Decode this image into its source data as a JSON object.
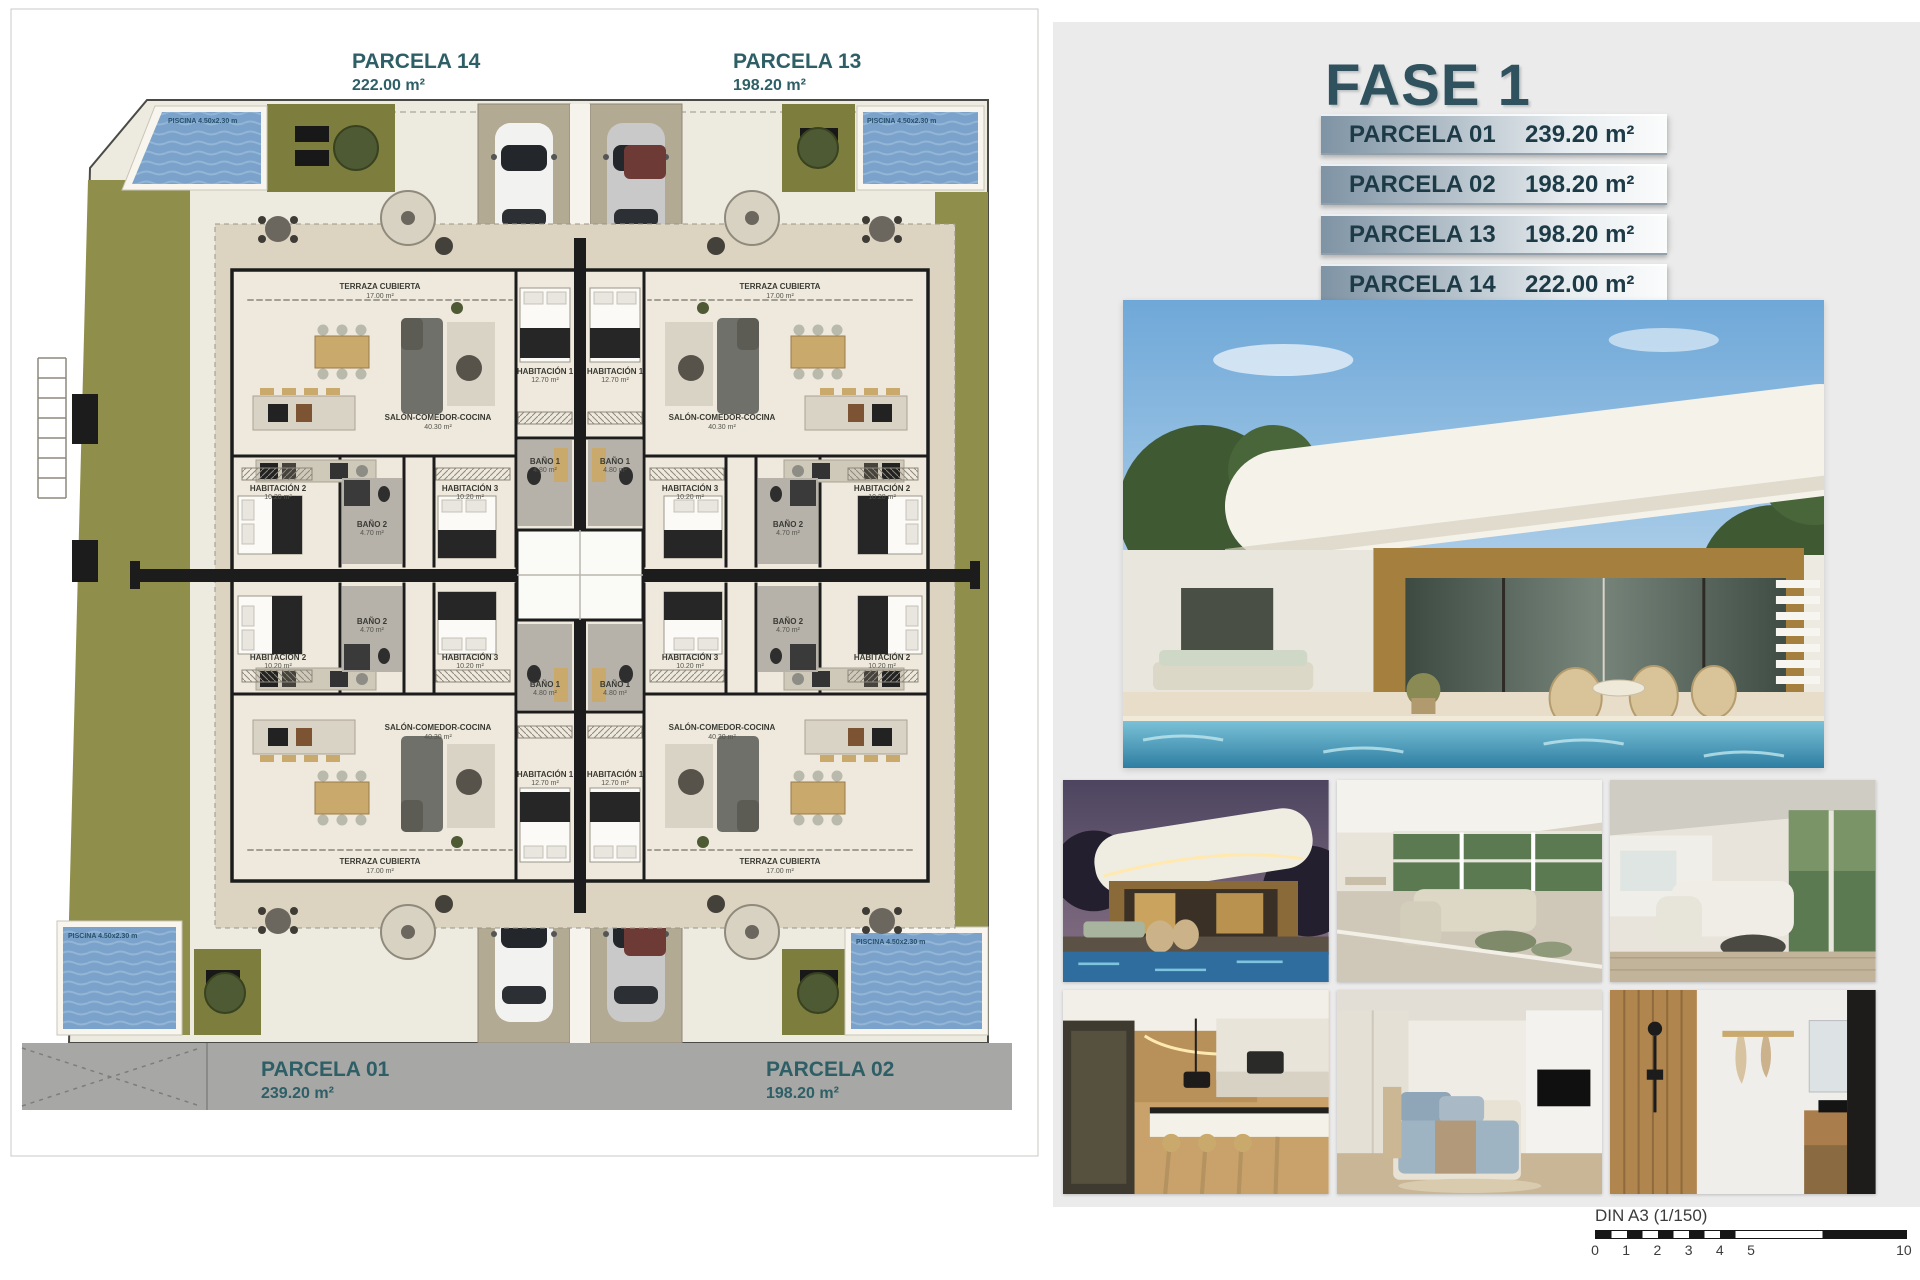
{
  "plan": {
    "parcels": {
      "top_left": {
        "name": "PARCELA 14",
        "area": "222.00 m²"
      },
      "top_right": {
        "name": "PARCELA 13",
        "area": "198.20 m²"
      },
      "bottom_left": {
        "name": "PARCELA 01",
        "area": "239.20 m²"
      },
      "bottom_right": {
        "name": "PARCELA 02",
        "area": "198.20 m²"
      }
    },
    "pool_label": "PISCINA 4.50x2.30 m",
    "rooms": {
      "terraza": {
        "label": "TERRAZA CUBIERTA",
        "area": "17.00 m²"
      },
      "salon": {
        "label": "SALÓN-COMEDOR-COCINA",
        "area": "40.30 m²"
      },
      "hab1": {
        "label": "HABITACIÓN 1",
        "area": "12.70 m²"
      },
      "hab2": {
        "label": "HABITACIÓN 2",
        "area": "10.20 m²"
      },
      "hab3": {
        "label": "HABITACIÓN 3",
        "area": "10.20 m²"
      },
      "bano1": {
        "label": "BAÑO 1",
        "area": "4.80 m²"
      },
      "bano2": {
        "label": "BAÑO 2",
        "area": "4.70 m²"
      }
    }
  },
  "panel": {
    "title": "FASE 1",
    "rows": [
      {
        "name": "PARCELA 01",
        "area": "239.20 m²"
      },
      {
        "name": "PARCELA 02",
        "area": "198.20 m²"
      },
      {
        "name": "PARCELA 13",
        "area": "198.20 m²"
      },
      {
        "name": "PARCELA 14",
        "area": "222.00 m²"
      }
    ]
  },
  "scalebar": {
    "label": "DIN A3 (1/150)",
    "ticks": [
      "0",
      "1",
      "2",
      "3",
      "4",
      "5",
      "10"
    ]
  },
  "colors": {
    "teal": "#2e5f66",
    "table_text": "#1d3a47",
    "grass": "#8f8f4b",
    "pool": "#7aa2cb",
    "road": "#a7a7a5",
    "wall": "#1c1c1c",
    "floor": "#ece7da",
    "panel_bg": "#ebebeb"
  }
}
